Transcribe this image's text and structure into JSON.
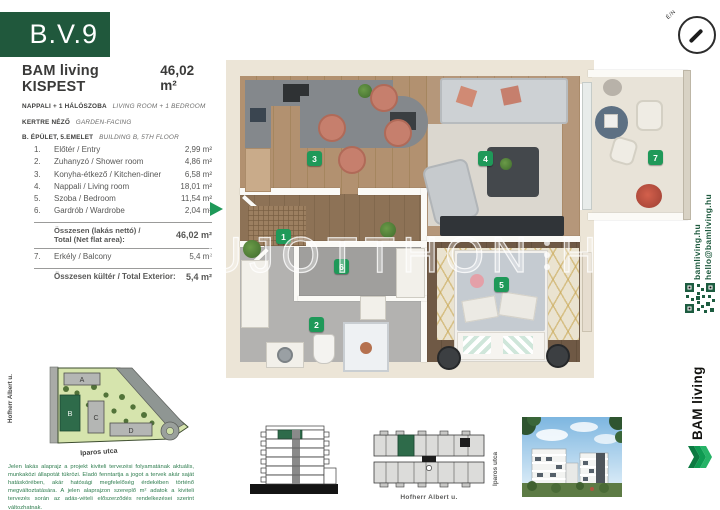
{
  "unit": {
    "id": "B.V.9"
  },
  "project": {
    "name": "BAM living KISPEST",
    "total_area": "46,02 m²"
  },
  "specs": [
    {
      "hu": "NAPPALI + 1 HÁLÓSZOBA",
      "en": "LIVING ROOM + 1 BEDROOM"
    },
    {
      "hu": "KERTRE NÉZŐ",
      "en": "GARDEN-FACING"
    },
    {
      "hu": "B. ÉPÜLET, 5.EMELET",
      "en": "BUILDING B, 5TH FLOOR"
    }
  ],
  "rooms": [
    {
      "num": "1.",
      "name": "Előtér / Entry",
      "area": "2,99 m²"
    },
    {
      "num": "2.",
      "name": "Zuhanyzó / Shower room",
      "area": "4,86 m²"
    },
    {
      "num": "3.",
      "name": "Konyha-étkező / Kitchen-diner",
      "area": "6,58 m²"
    },
    {
      "num": "4.",
      "name": "Nappali / Living room",
      "area": "18,01 m²"
    },
    {
      "num": "5.",
      "name": "Szoba / Bedroom",
      "area": "11,54 m²"
    },
    {
      "num": "6.",
      "name": "Gardrób / Wardrobe",
      "area": "2,04 m²"
    }
  ],
  "totals": {
    "net_label_line1": "Összesen (lakás nettó) /",
    "net_label_line2": "Total (Net flat area):",
    "net_value": "46,02 m²",
    "exterior_row": {
      "num": "7.",
      "name": "Erkély / Balcony",
      "area": "5,4 m²"
    },
    "ext_label": "Összesen kültér / Total Exterior:",
    "ext_value": "5,4 m²"
  },
  "plan_labels": [
    "1",
    "2",
    "3",
    "4",
    "5",
    "6",
    "7"
  ],
  "watermark": {
    "part1": "UJOTTHON",
    "part2": "HU"
  },
  "compass": {
    "label": "É/N"
  },
  "contact": {
    "web": "bamliving.hu",
    "email": "hello@bamliving.hu"
  },
  "brand": {
    "name": "BAM living"
  },
  "siteplan": {
    "street_left": "Hofherr Albert u.",
    "street_bottom": "Iparos utca",
    "buildings": [
      "A",
      "B",
      "C",
      "D"
    ]
  },
  "diagrams": {
    "floorplate_street": "Hofherr Albert u.",
    "render_street": "Iparos utca"
  },
  "disclaimer": "Jelen lakás alaprajz a projekt kiviteli tervezési folyamatának aktuális, munkaközi állapotát tükrözi. Eladó fenntartja a jogot a tervek akár saját hatáskörében, akár hatósági megfelelőség érdekében történő megváltoztatására. A jelen alaprajzon szereplő m² adatok a kiviteli tervezés során az adás-vételi előszerződés rendelkezései szerint változhatnak.",
  "colors": {
    "brand_green": "#20583c",
    "label_green": "#1f9959"
  }
}
